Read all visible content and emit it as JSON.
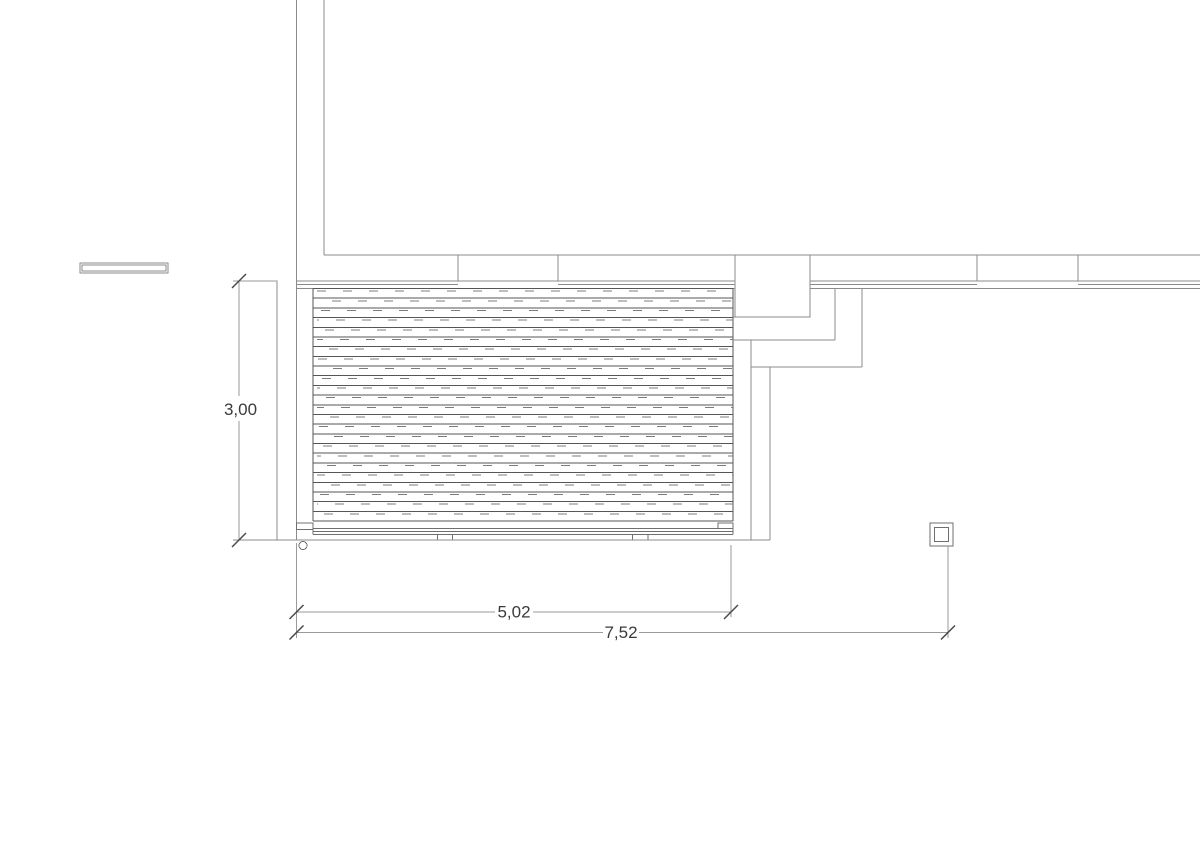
{
  "drawing": {
    "type": "architectural-plan",
    "subject": "terrace decking plan, top view, with wall, steps, post and dimension lines",
    "background_color": "#ffffff",
    "line_colors": {
      "outline": "#8b8b8b",
      "detail": "#6f6f6f",
      "plank": "#565656",
      "plank_joint": "#7c7c7c",
      "dimension_line": "#9a9a9a",
      "dimension_tick": "#4a4a4a",
      "dimension_text": "#3a3a3a"
    },
    "deck": {
      "plank_count": 24,
      "plank_orientation": "horizontal"
    },
    "dimensions": [
      {
        "id": "deck-depth",
        "label": "3,00",
        "value": 3.0,
        "unit": "m",
        "orientation": "vertical"
      },
      {
        "id": "deck-width",
        "label": "5,02",
        "value": 5.02,
        "unit": "m",
        "orientation": "horizontal"
      },
      {
        "id": "overall-width",
        "label": "7,52",
        "value": 7.52,
        "unit": "m",
        "orientation": "horizontal"
      }
    ]
  }
}
